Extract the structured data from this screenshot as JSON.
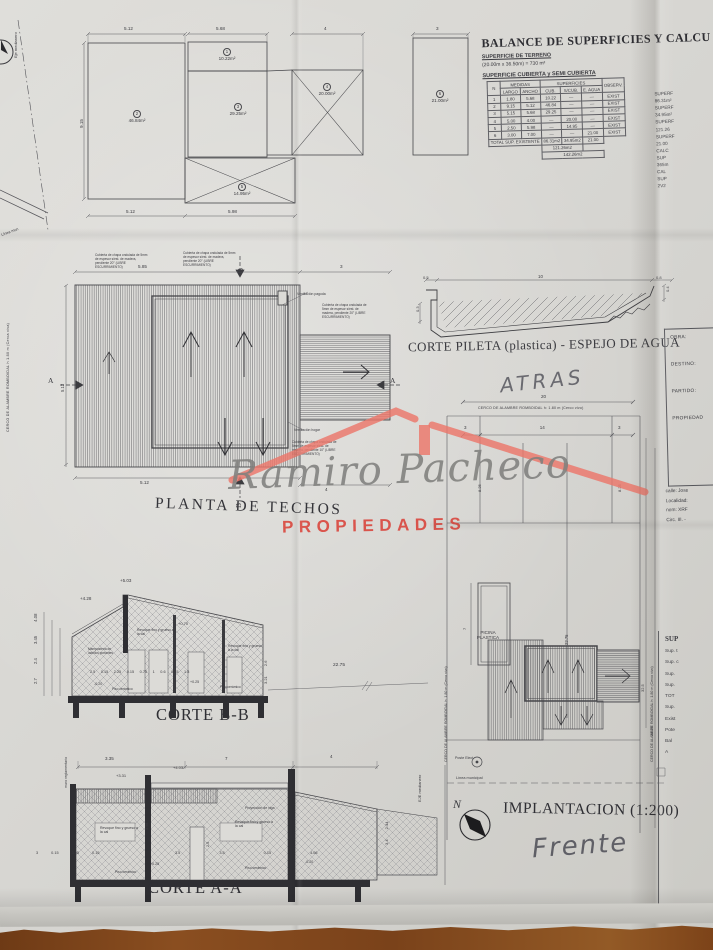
{
  "colors": {
    "paper": "#d8d7d3",
    "ink": "#46464a",
    "wood": "#7c4218",
    "logo_red": "#e8705f",
    "logo_gray": "#87878a"
  },
  "balance": {
    "title": "BALANCE DE SUPERFICIES Y CALCU",
    "terreno_label": "SUPERFICIE DE TERRENO",
    "terreno_value": "(20.00m x 36.50m) = 730 m²",
    "cubierta_label": "SUPERFICIE CUBIERTA y SEMI CUBIERTA",
    "table": {
      "col_n": "N",
      "grp_medidas": "MEDIDAS",
      "grp_superficies": "SUPERFICIES",
      "col_largo": "LARGO",
      "col_ancho": "ANCHO",
      "col_cub": "CUB.",
      "col_scub": "S/CUB.",
      "col_eagua": "E. AGUA",
      "col_observ": "OBSERV.",
      "rows": [
        [
          "1",
          "1.80",
          "5.68",
          "10.22",
          "—",
          "—",
          "EXIST"
        ],
        [
          "2",
          "9.15",
          "5.12",
          "46.84",
          "—",
          "—",
          "EXIST"
        ],
        [
          "3",
          "5.15",
          "5.68",
          "29.25",
          "—",
          "—",
          "EXIST"
        ],
        [
          "4",
          "5.00",
          "4.00",
          "—",
          "20.00",
          "—",
          "EXIST"
        ],
        [
          "5",
          "2.50",
          "5.98",
          "—",
          "14.95",
          "—",
          "EXIST"
        ],
        [
          "6",
          "3.00",
          "7.00",
          "—",
          "—",
          "21.00",
          "EXIST"
        ]
      ],
      "total_label": "TOTAL SUP. EXISTENTE",
      "total_cub": "86.31m2",
      "total_scub": "34.95m2",
      "total_eagua": "21.00",
      "subtotal": "121.26m2",
      "grand_total": "142.26m2"
    },
    "side_fragments": "SUPERF\n86.31m²\nSUPERF\n34.95m²\nSUPERF\n121.26\nSUPERF\n21.00\nCALC\nSUP\n365m\nCAL\nSUP\n2V2"
  },
  "floor_plan": {
    "eje_label": "Eje medianero",
    "linea_fragment": "Línea mun",
    "rooms": [
      {
        "n": "1",
        "area": "10.22m²"
      },
      {
        "n": "2",
        "area": "46.84m²"
      },
      {
        "n": "3",
        "area": "29.25m²"
      },
      {
        "n": "4",
        "area": "20.00m²"
      },
      {
        "n": "5",
        "area": "14.95m²"
      },
      {
        "n": "6",
        "area": "21.00m²"
      }
    ],
    "dims": {
      "top1": "5.12",
      "top2": "5.68",
      "top3": "4",
      "top4": "3",
      "bottom1": "5.12",
      "bottom2": "5.98",
      "left": "9.15"
    }
  },
  "pool_section": {
    "label": "CORTE PILETA (plastica) - ESPEJO DE AGUA",
    "dims": {
      "d05": "0.5",
      "d10": "10",
      "d08": "0.8",
      "d04": "0.4",
      "d03": "0.3"
    }
  },
  "title_block": {
    "obra": "OBRA:",
    "destino": "DESTINO:",
    "partido": "PARTIDO:",
    "propiedad": "PROPIEDAD",
    "location": "calle: Jose\nLocalidad:\nnom: XRF\nCirc. III. -",
    "bottom_header": "SUP",
    "bottom_lines": "Sup. t\nSup. c\nSup.\nSup.\nTOT\nSup.\nExist\nPote\nBal\nA"
  },
  "handwriting": {
    "atras": "ATRAS",
    "frente": "Frente"
  },
  "roof_plan": {
    "label": "PLANTA DE TECHOS",
    "note": "Cubierta de chapa ondulada de 5mm de espesor s/est. de madera, pendiente 20° (LIBRE ESCURRIMIENTO)",
    "note_low": "Cubierta de chapa ondulada de 5mm de espesor s/est. de madera, pendiente 10° (LIBRE ESCURRIMIENTO)",
    "vent_top": "Ventilación pagoda",
    "vent_hogar": "Ventilación hogar",
    "cerco_left": "CERCO DE ALAMBRE ROMBOIDAL h 1.80 m (Cerca viva)",
    "dims": {
      "top": "5.85",
      "top_right": "3",
      "bottom": "5.12",
      "bottom_right": "4",
      "left": "5.12"
    },
    "marker_a": "A",
    "marker_b": "B"
  },
  "watermark": {
    "name": "Ramiro Pacheco",
    "subtitle": "PROPIEDADES"
  },
  "site_plan": {
    "cerco_top": "CERCO DE ALAMBRE ROMBOIDAL h: 1.80 m (Cerco vivo)",
    "cerco_side": "CERCO DE ALAMBRE ROMBOIDAL h: 1.80 m (Cerco vivo)",
    "dims": {
      "top": "20",
      "row": "3 14 3",
      "left825": "8.25",
      "right825": "8.25",
      "mid": "22.75",
      "right1": "28.25",
      "right2": "32.5",
      "pool": "7"
    },
    "pool_label": "PICINA\nPLASTICA",
    "linea_municipal": "Línea municipal",
    "poste": "Poste Elect.",
    "north": "N",
    "title": "IMPLANTACION (1:200)"
  },
  "corte_bb": {
    "label": "CORTE B-B",
    "p503": "+5.03",
    "p428": "+4.28",
    "p070": "+0.70",
    "m020": "-0.20",
    "p025": "+0.25",
    "left_dims": "2.7 2.4 3.45 4.08",
    "bottom_dims": "2.5 0.15 2.25 0.15 0.75 1 0.6 0.15 1.8",
    "right_dims": "3.21 2.6",
    "ext_dim": "22.75",
    "note_revoque": "Revoque fino y grueso a la cal",
    "note_mamposteria": "Mampostería de ladrillos portantes",
    "note_piso": "Piso cerámico"
  },
  "corte_aa": {
    "label": "CORTE A-A",
    "top1": "3.35",
    "top2": "7",
    "top3": "4",
    "p331": "+3.31",
    "p403": "+4.03",
    "p025": "+0.25",
    "m020": "-0.20",
    "bottom_dims_left": "3 0.15 3.35 0.15",
    "bottom_dims_right": "3.5 3.5 0.15 4.06",
    "dim398": "3.98",
    "dim25": "2.5",
    "right_dims": "3.4 2.44",
    "note_proyeccion": "Proyección de viga",
    "note_revoque": "Revoque fino y grueso a la cal",
    "note_piso": "Piso cerámico",
    "eje": "EJE medianero",
    "muro": "muro reglamentario"
  }
}
